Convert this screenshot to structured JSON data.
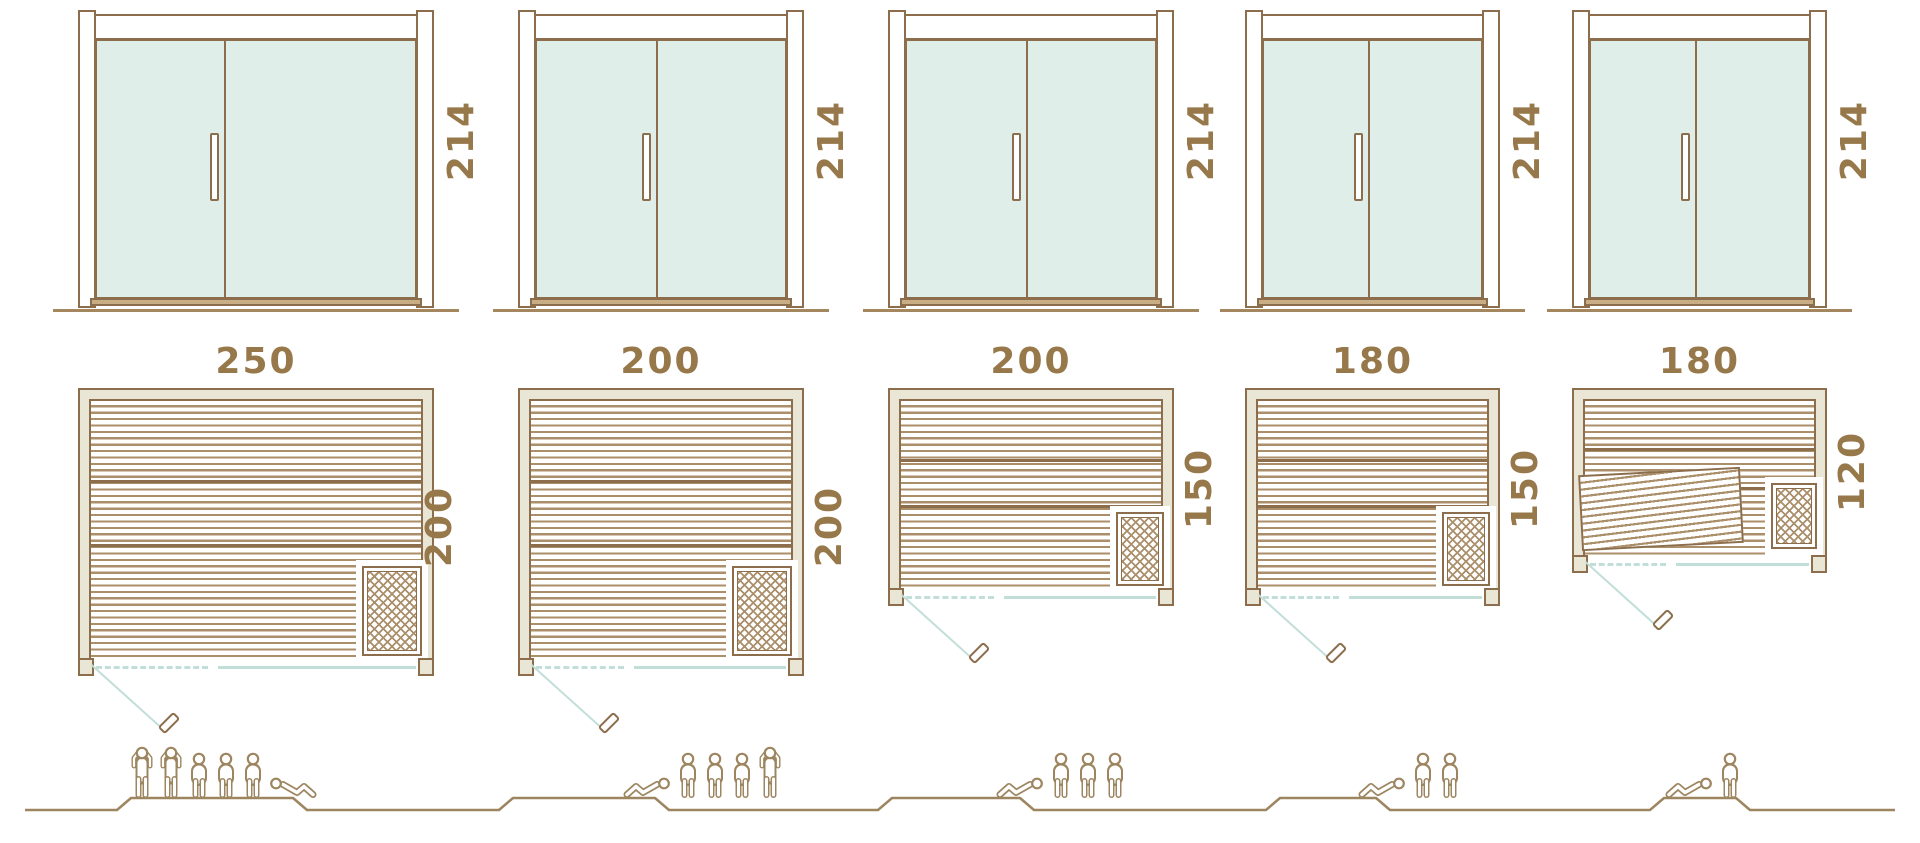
{
  "palette": {
    "outline_brown": "#8d6e4c",
    "label_brown": "#97784a",
    "glass_mint": "#e0eeea",
    "wall_fill_cream": "#eae6d5",
    "board_stripe": "#ab8f6a",
    "glass_front_teal": "#c2ded9",
    "people_brown": "#9d8560"
  },
  "units": [
    {
      "door_height": "214",
      "plan_width": "250",
      "plan_depth": "200",
      "people": [
        "standing",
        "standing",
        "sitting",
        "sitting",
        "sitting",
        "lying-right"
      ]
    },
    {
      "door_height": "214",
      "plan_width": "200",
      "plan_depth": "200",
      "people": [
        "lying-left",
        "sitting",
        "sitting",
        "sitting",
        "standing"
      ]
    },
    {
      "door_height": "214",
      "plan_width": "200",
      "plan_depth": "150",
      "people": [
        "lying-left",
        "sitting",
        "sitting",
        "sitting"
      ]
    },
    {
      "door_height": "214",
      "plan_width": "180",
      "plan_depth": "150",
      "people": [
        "lying-left",
        "sitting",
        "sitting"
      ]
    },
    {
      "door_height": "214",
      "plan_width": "180",
      "plan_depth": "120",
      "people": [
        "lying-left",
        "sitting"
      ]
    }
  ]
}
